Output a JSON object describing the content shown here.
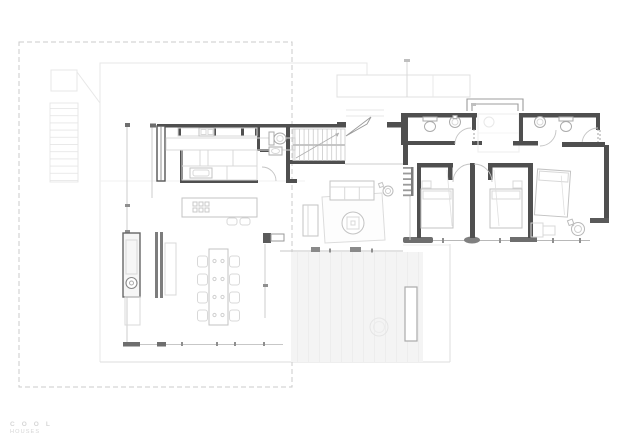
{
  "branding": {
    "line1": "C O O L",
    "line2": "HOUSES"
  },
  "colors": {
    "wall": "#4f4f4f",
    "wall-mid": "#8c8c8c",
    "furn": "#c3c3c3",
    "furn-light": "#d8d8d8",
    "line-light": "#cccccc",
    "faint": "#e7e7e7",
    "fainter": "#f1f1f1",
    "dash": "#cbcbcb",
    "terrace": "#f4f4f4",
    "plank": "#ebebeb",
    "logo": "#d6d6d6",
    "hatch": "#cfcfcf",
    "arc": "#c4c4c4"
  },
  "plan": {
    "type": "residential-floor-plan",
    "rooms": [
      "kitchen",
      "powder-room",
      "entry-stairs",
      "living-room",
      "dining-area",
      "hallway",
      "bathroom-1",
      "bathroom-2",
      "bedroom-1",
      "bedroom-2",
      "master-bedroom",
      "terrace"
    ],
    "furniture_counts": {
      "dining-chairs": 8,
      "bar-stools": 2,
      "beds": 3,
      "toilets": 3,
      "sinks": 3,
      "sofas": 1,
      "coffee-tables": 1,
      "plants": 2
    }
  }
}
